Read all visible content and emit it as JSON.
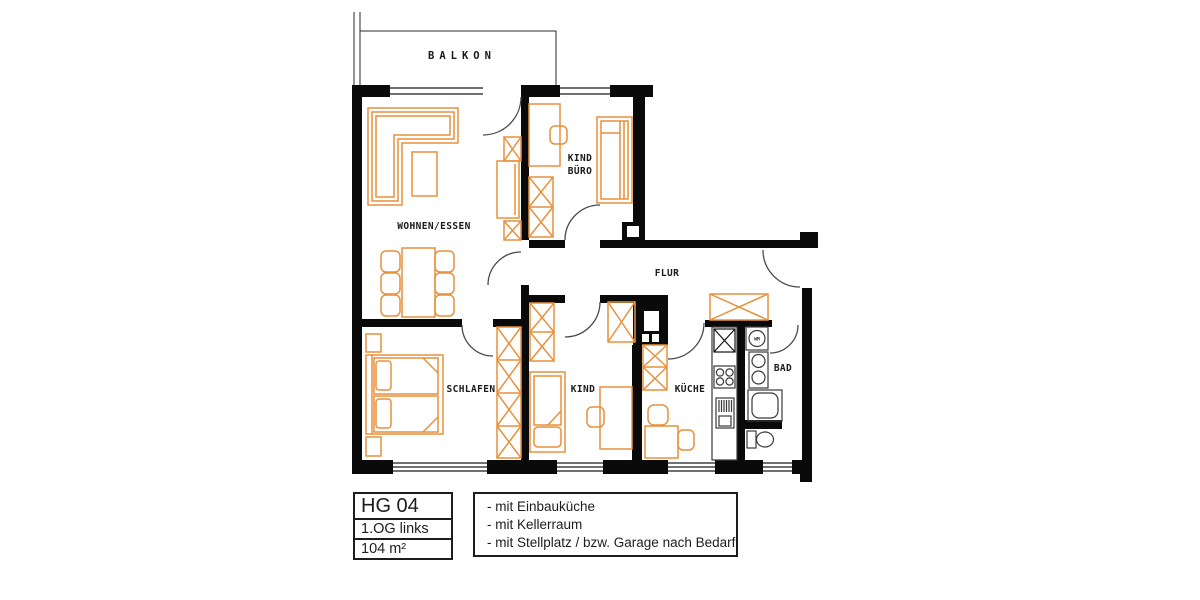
{
  "plan": {
    "balcony_label": "BALKON",
    "rooms": {
      "living": "WOHNEN/ESSEN",
      "child_office_line1": "KIND",
      "child_office_line2": "BÜRO",
      "hall": "FLUR",
      "bedroom": "SCHLAFEN",
      "child": "KIND",
      "kitchen": "KÜCHE",
      "bath": "BAD"
    },
    "fixtures": {
      "washing_machine": "WM"
    }
  },
  "info": {
    "unit_id": "HG 04",
    "floor": "1.OG links",
    "area": "104 m²",
    "features": [
      "- mit Einbauküche",
      "- mit Kellerraum",
      "- mit Stellplatz / bzw. Garage nach Bedarf"
    ]
  },
  "colors": {
    "walls": "#0a0a0a",
    "furniture": "#E8913C",
    "fixtures": "#3a3a3a"
  }
}
